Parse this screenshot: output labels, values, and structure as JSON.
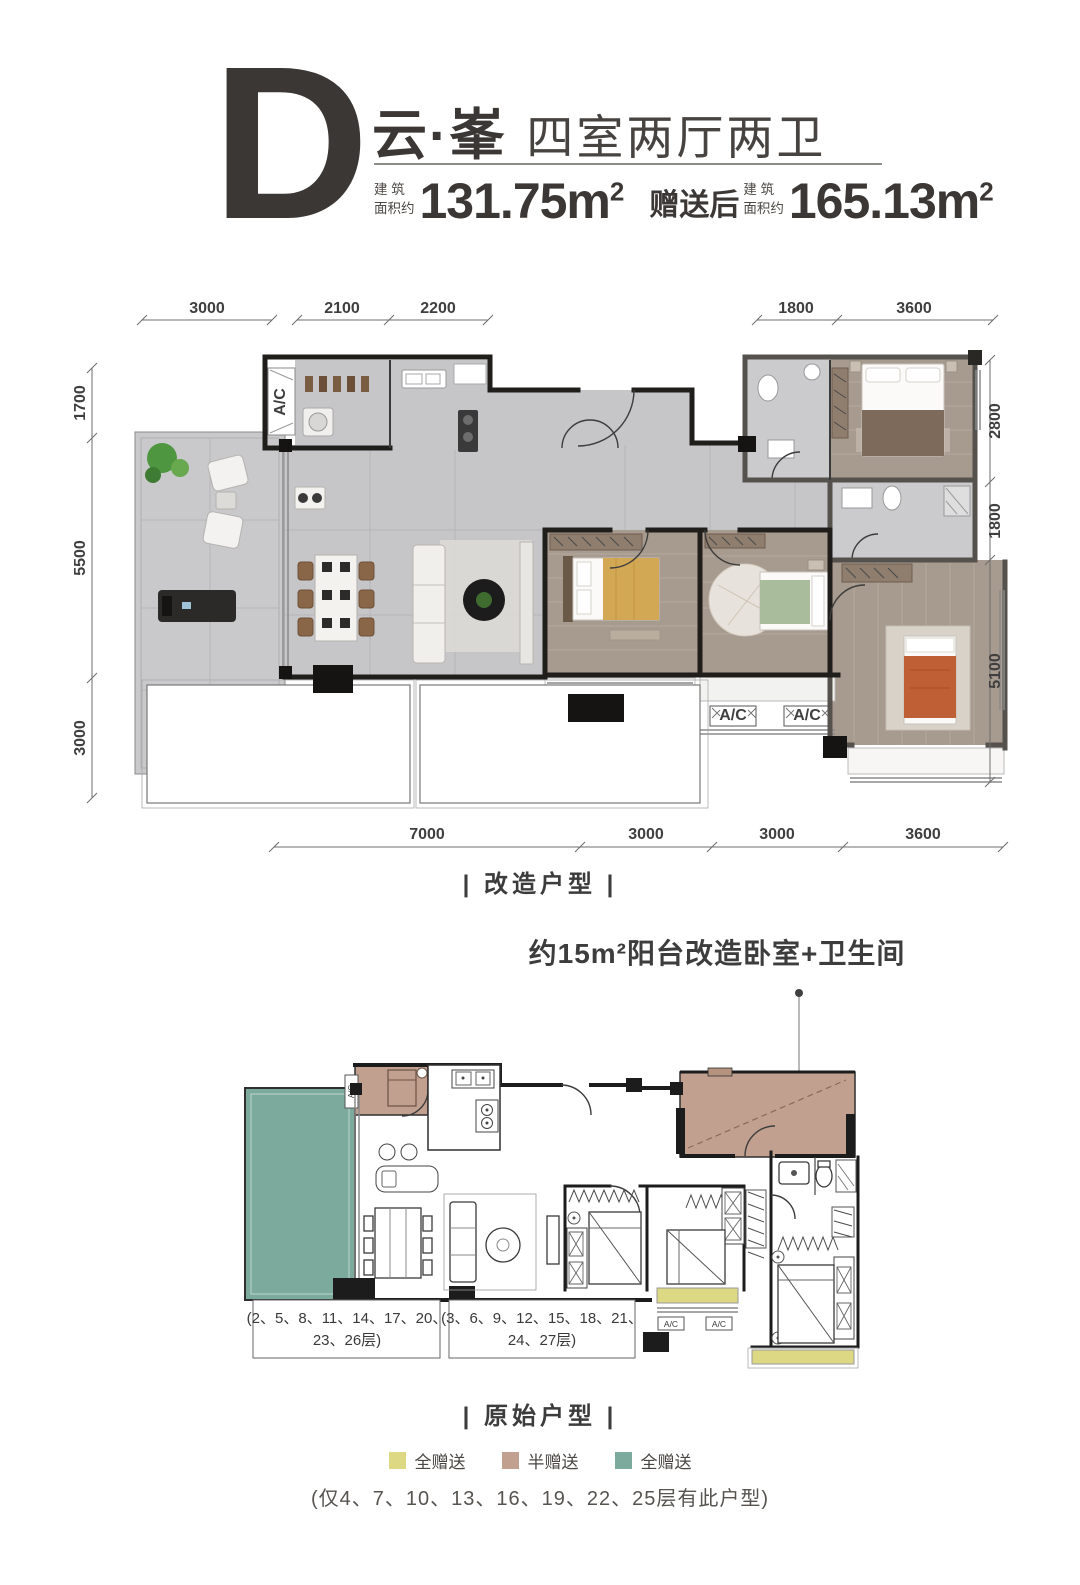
{
  "header": {
    "letter": "D",
    "title": "云·峯",
    "subtitle": "四室两厅两卫",
    "area_label_line1": "建 筑",
    "area_label_line2": "面积约",
    "area_value": "131.75m",
    "area_sup": "2",
    "bonus_prefix": "赠送后",
    "bonus_label_line1": "建 筑",
    "bonus_label_line2": "面积约",
    "bonus_value": "165.13m",
    "bonus_sup": "2"
  },
  "plan_renovated": {
    "caption": "| 改造户型 |",
    "ac_label": "A/C",
    "dims_top": [
      "3000",
      "2100",
      "2200",
      "1800",
      "3600"
    ],
    "dims_left": [
      "1700",
      "5500",
      "3000"
    ],
    "dims_right": [
      "2800",
      "1800",
      "5100"
    ],
    "dims_bottom": [
      "7000",
      "3000",
      "3000",
      "3600"
    ]
  },
  "annotation": {
    "balcony_note": "约15m²阳台改造卧室+卫生间"
  },
  "plan_original": {
    "caption": "| 原始户型 |",
    "ac_label": "A/C",
    "floors_left_line1": "(2、5、8、11、14、17、20、",
    "floors_left_line2": "23、26层)",
    "floors_right_line1": "(3、6、9、12、15、18、21、",
    "floors_right_line2": "24、27层)"
  },
  "legend": {
    "items": [
      {
        "label": "全赠送",
        "color": "#ddd884"
      },
      {
        "label": "半赠送",
        "color": "#c2a08f"
      },
      {
        "label": "全赠送",
        "color": "#7cab9e"
      }
    ],
    "note": "(仅4、7、10、13、16、19、22、25层有此户型)"
  },
  "colors": {
    "marble_floor": "#c6c6c8",
    "wood_floor": "#a79a8e",
    "wall_dark": "#201e1b",
    "accent_text": "#3b3734"
  }
}
